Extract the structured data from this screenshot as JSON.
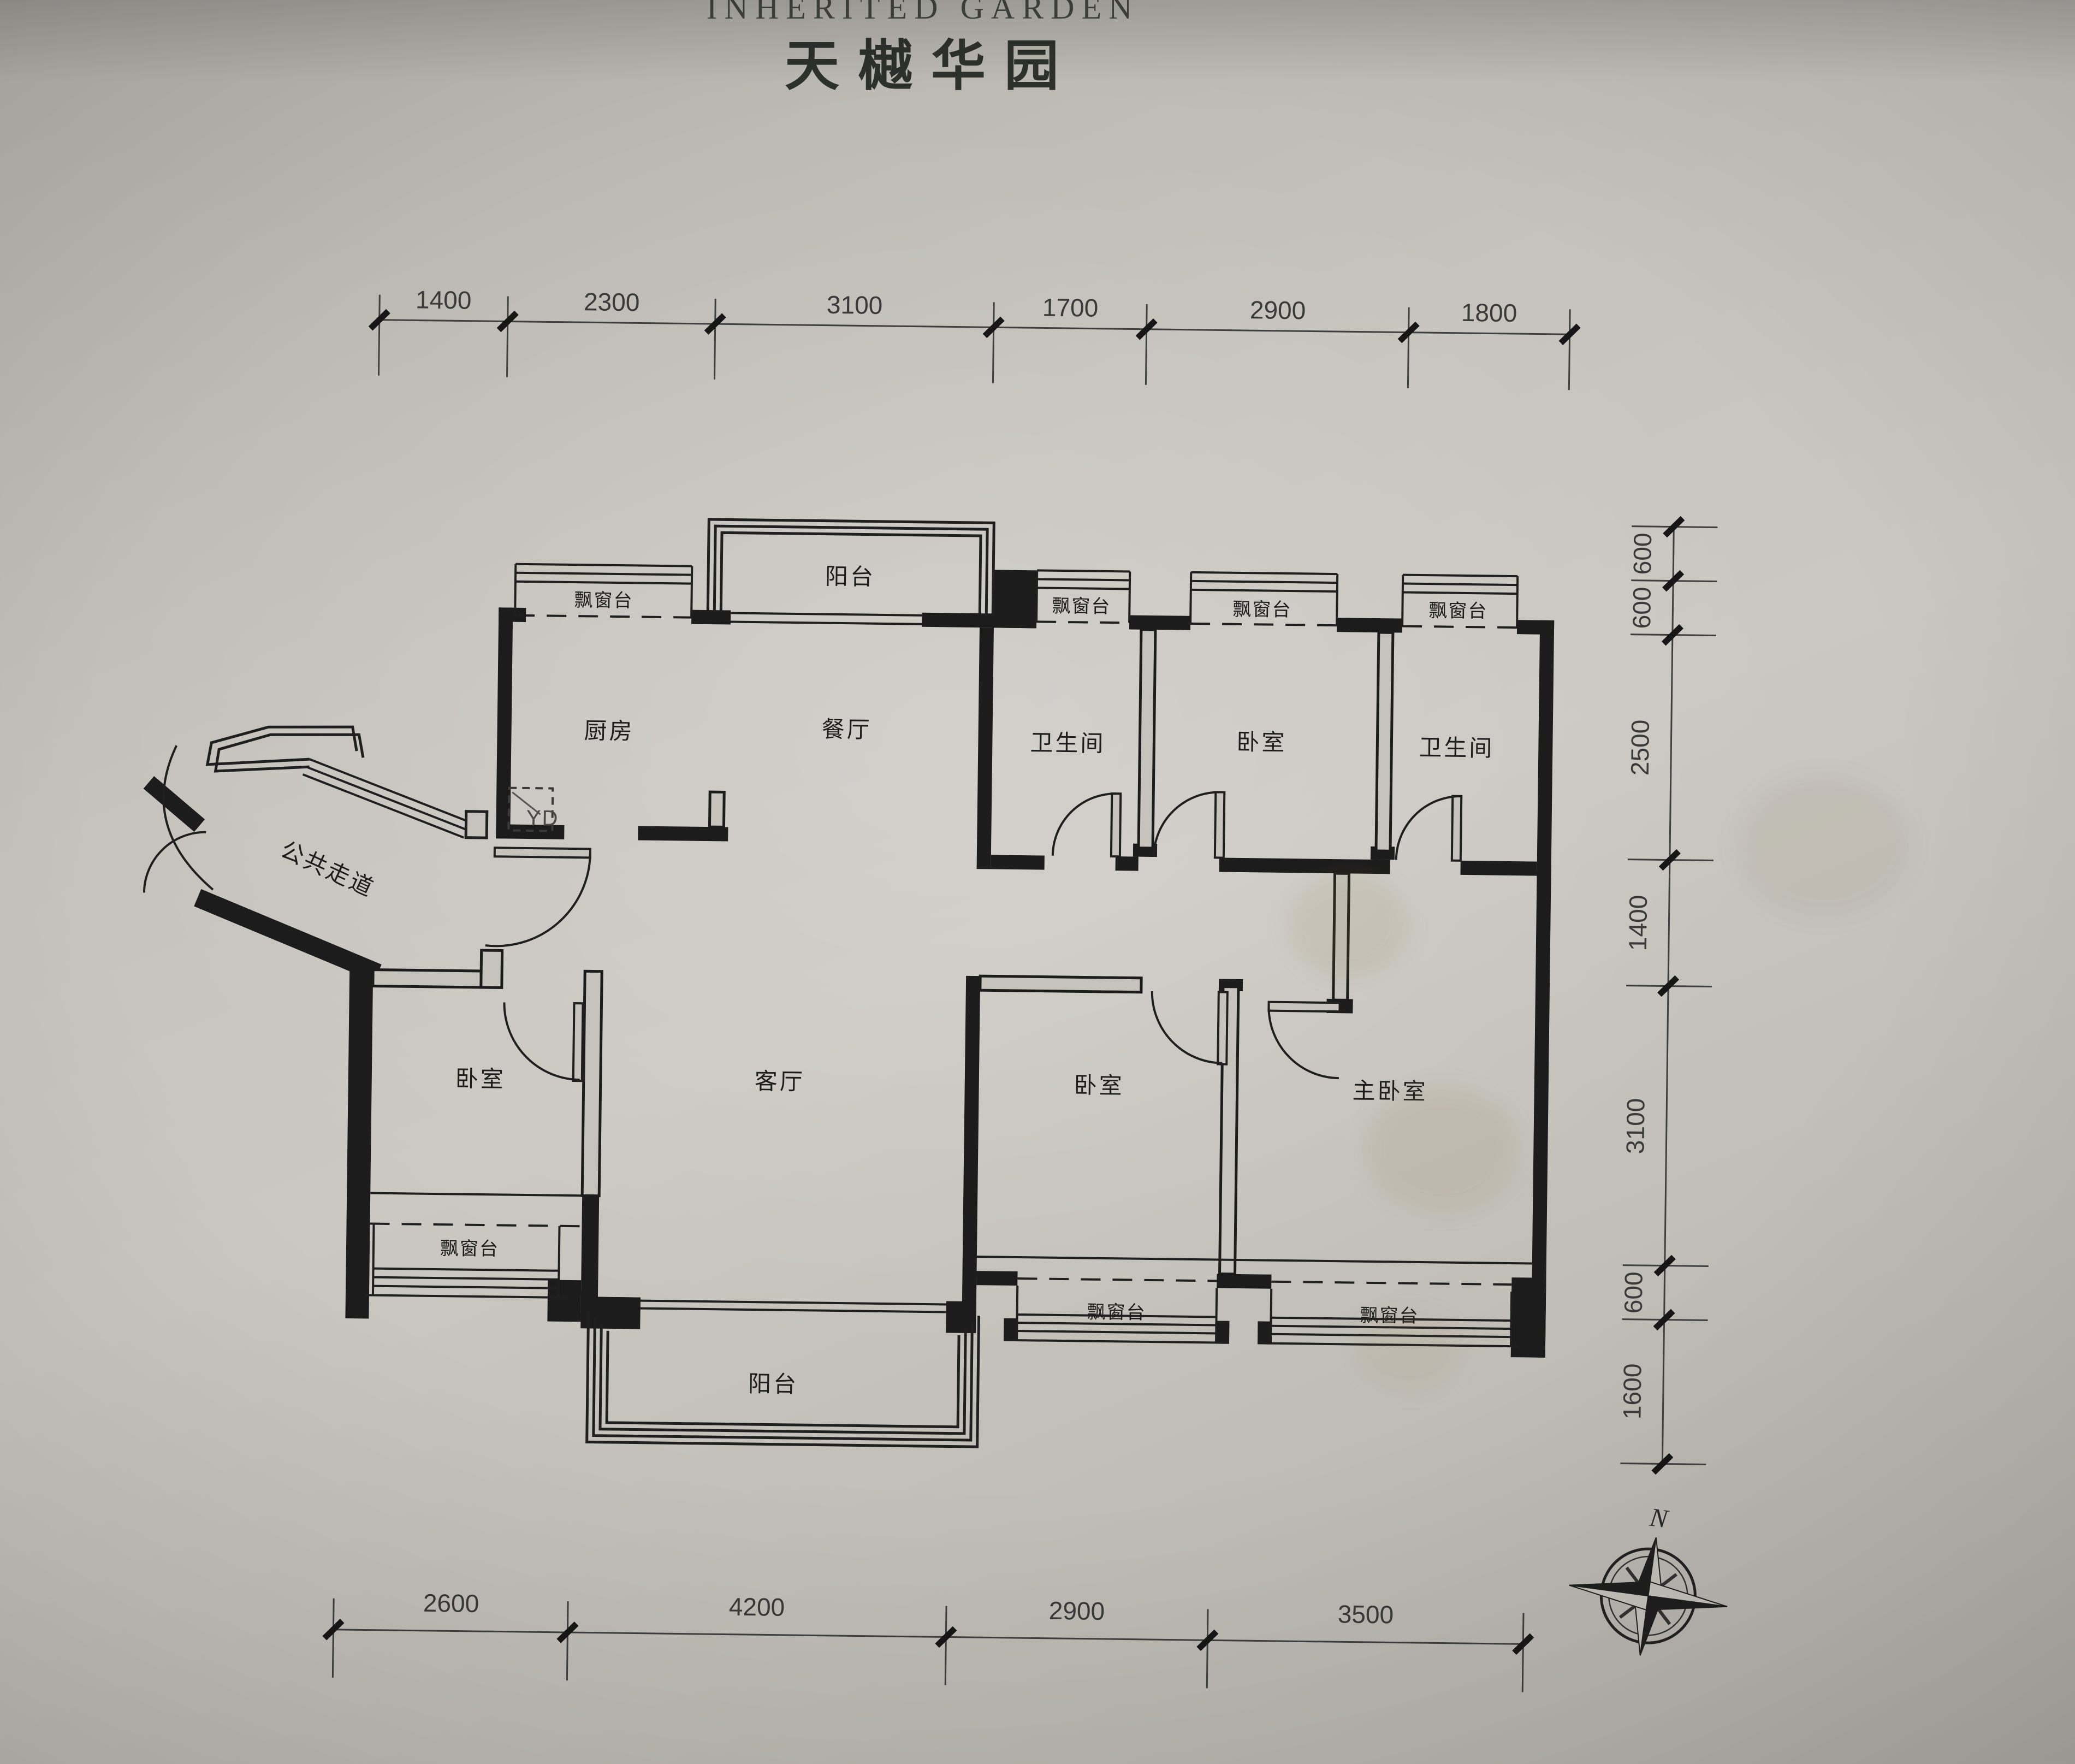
{
  "header": {
    "title_en": "INHERITED GARDEN",
    "title_cn": "天樾华园"
  },
  "rooms": {
    "kitchen": "厨房",
    "dining": "餐厅",
    "bath1": "卫生间",
    "bedroom2": "卧室",
    "bath2": "卫生间",
    "public_corridor": "公共走道",
    "bedroom3": "卧室",
    "living": "客厅",
    "bedroom4": "卧室",
    "master": "主卧室",
    "balcony_top": "阳台",
    "balcony_bottom": "阳台"
  },
  "bay_window_label": "飘窗台",
  "flue_label": "YD",
  "compass": {
    "north": "N"
  },
  "dims": {
    "top": [
      "1400",
      "2300",
      "3100",
      "1700",
      "2900",
      "1800"
    ],
    "right": [
      "600",
      "600",
      "2500",
      "1400",
      "3100",
      "600",
      "1600"
    ],
    "bottom": [
      "2600",
      "4200",
      "2900",
      "3500"
    ]
  },
  "colors": {
    "paper": "#c6c3bd",
    "ink": "#1f1f1f",
    "dim_ink": "#3a3a3a"
  }
}
